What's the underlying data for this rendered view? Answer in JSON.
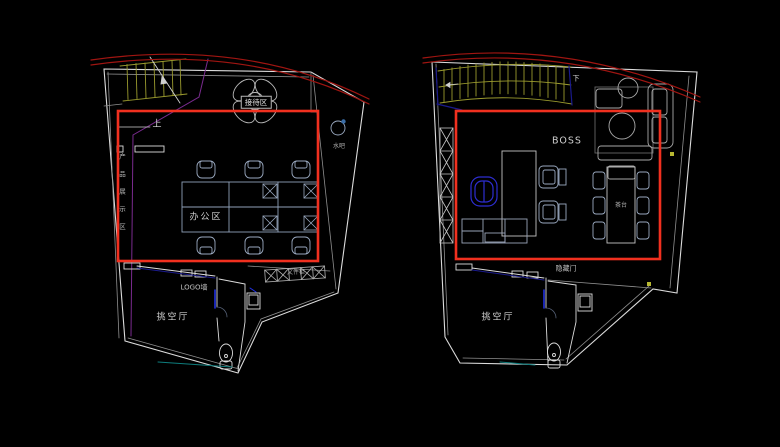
{
  "canvas": {
    "width": 780,
    "height": 447,
    "background": "#000000"
  },
  "colors": {
    "background": "#000000",
    "highlight_box_red": "#f1301f",
    "arc_red": "#a01511",
    "wall_white": "#dcdcdc",
    "wall_gray": "#8f8f8f",
    "stair_olive": "#9a9a2e",
    "purple_line": "#7a2b8f",
    "navy_line": "#1a1a8c",
    "exec_chair_blue": "#2d2dd0",
    "accent_blue": "#2233ee",
    "teal_line": "#0e7d7d",
    "furniture_blue_gray": "#8fa0b8",
    "yellow_marker": "#b8b832",
    "label_gray": "#cfcfcf"
  },
  "left_plan": {
    "title": "office floor plan - open office level",
    "labels": {
      "reception": "接待区",
      "stairs_up": "上",
      "product_display": "产品展示区",
      "office_area": "办公区",
      "logo_wall": "LOGO墙",
      "void_hall": "挑空厅",
      "file_cabinet": "文件柜",
      "water_bar": "水吧"
    }
  },
  "right_plan": {
    "title": "office floor plan - boss office level",
    "labels": {
      "stairs_down": "下",
      "boss": "BOSS",
      "tea_table": "茶台",
      "hidden_door": "隐藏门",
      "void_hall": "挑空厅"
    }
  }
}
